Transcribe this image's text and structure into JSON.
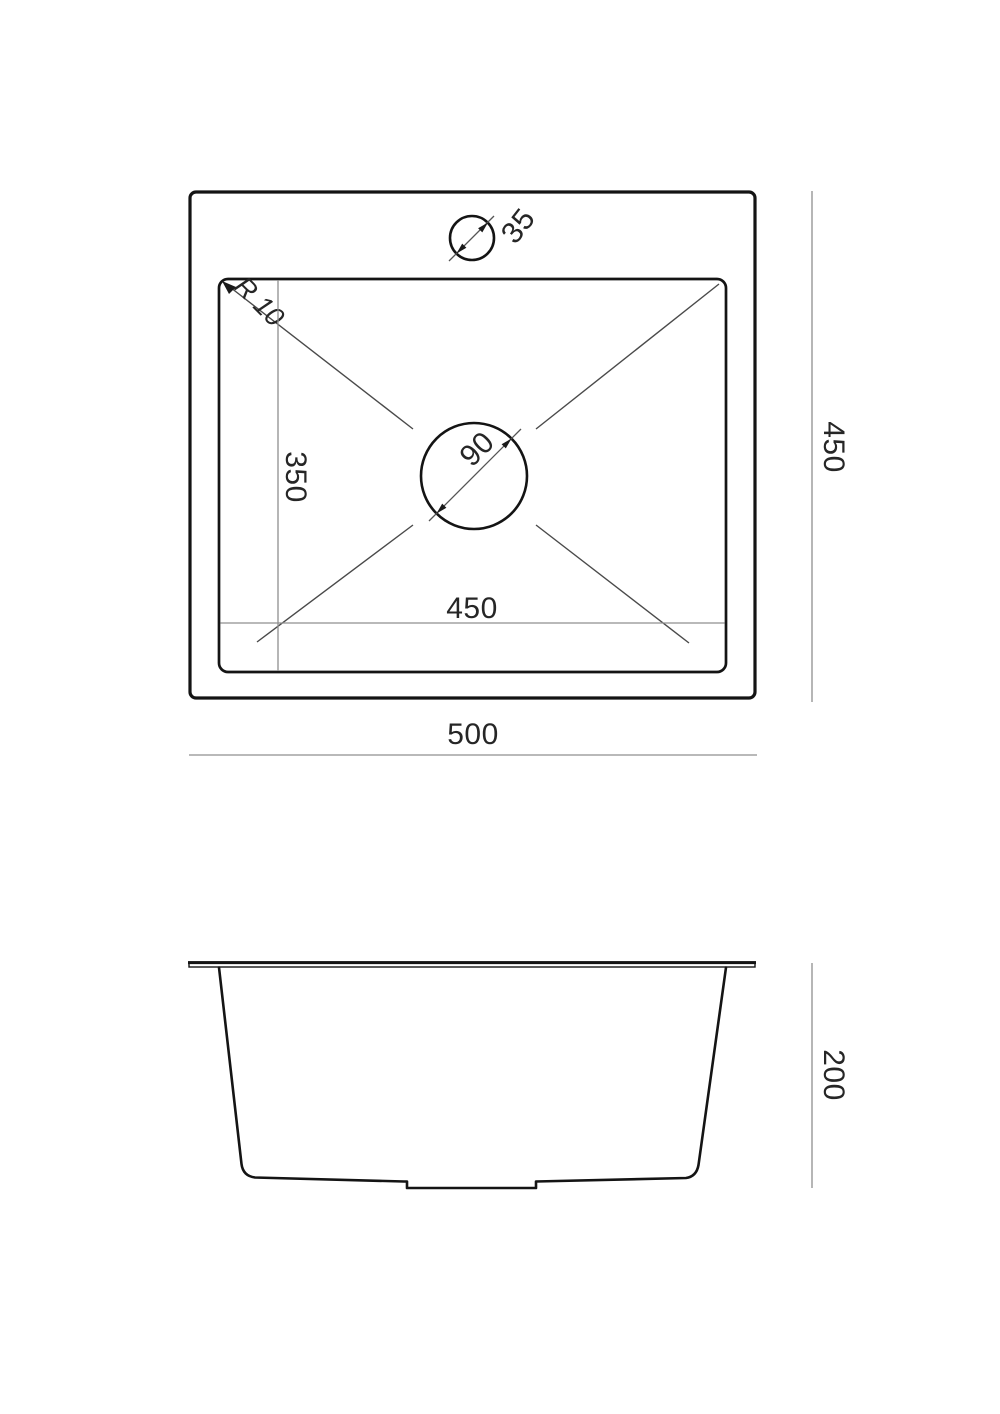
{
  "drawing": {
    "kind": "sink technical drawing, top view and side view",
    "colors": {
      "background": "#ffffff",
      "outline": "#141414",
      "dimension_line": "#8f8f8f",
      "diagonal_line": "#4a4a4a",
      "text": "#262626"
    }
  },
  "top_view": {
    "overall_width": "500",
    "overall_depth": "450",
    "bowl_width": "450",
    "bowl_depth": "350",
    "corner_radius": "R 10",
    "faucet_hole_diameter": "35",
    "drain_hole_diameter": "90"
  },
  "side_view": {
    "overall_height": "200"
  }
}
